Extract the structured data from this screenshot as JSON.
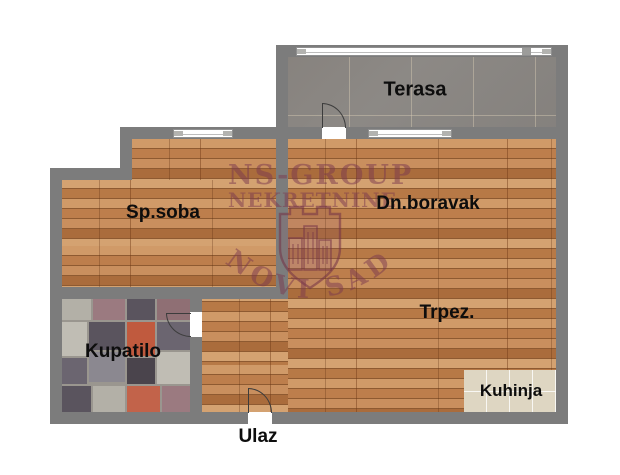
{
  "plan": {
    "type": "apartment-floor-plan",
    "rooms": {
      "terasa": "Terasa",
      "sp_soba": "Sp.soba",
      "dn_boravak": "Dn.boravak",
      "trpez": "Trpez.",
      "kupatilo": "Kupatilo",
      "kuhinja": "Kuhinja",
      "ulaz": "Ulaz"
    },
    "watermark": {
      "line1": "NS-GROUP",
      "line2": "NEKRETNINE",
      "city": "NOVI SAD",
      "logo": "shield-crest-with-buildings",
      "color": "#7a384d"
    },
    "colors": {
      "wall": "#7c7c7c",
      "wood_floor": "#c08253",
      "terrace_floor": "#8a8784",
      "kitchen_tile": "#ded6c2",
      "bathroom_tile_accent": "#c05a3e",
      "label_text": "#0d0d0d",
      "background": "#ffffff"
    }
  }
}
